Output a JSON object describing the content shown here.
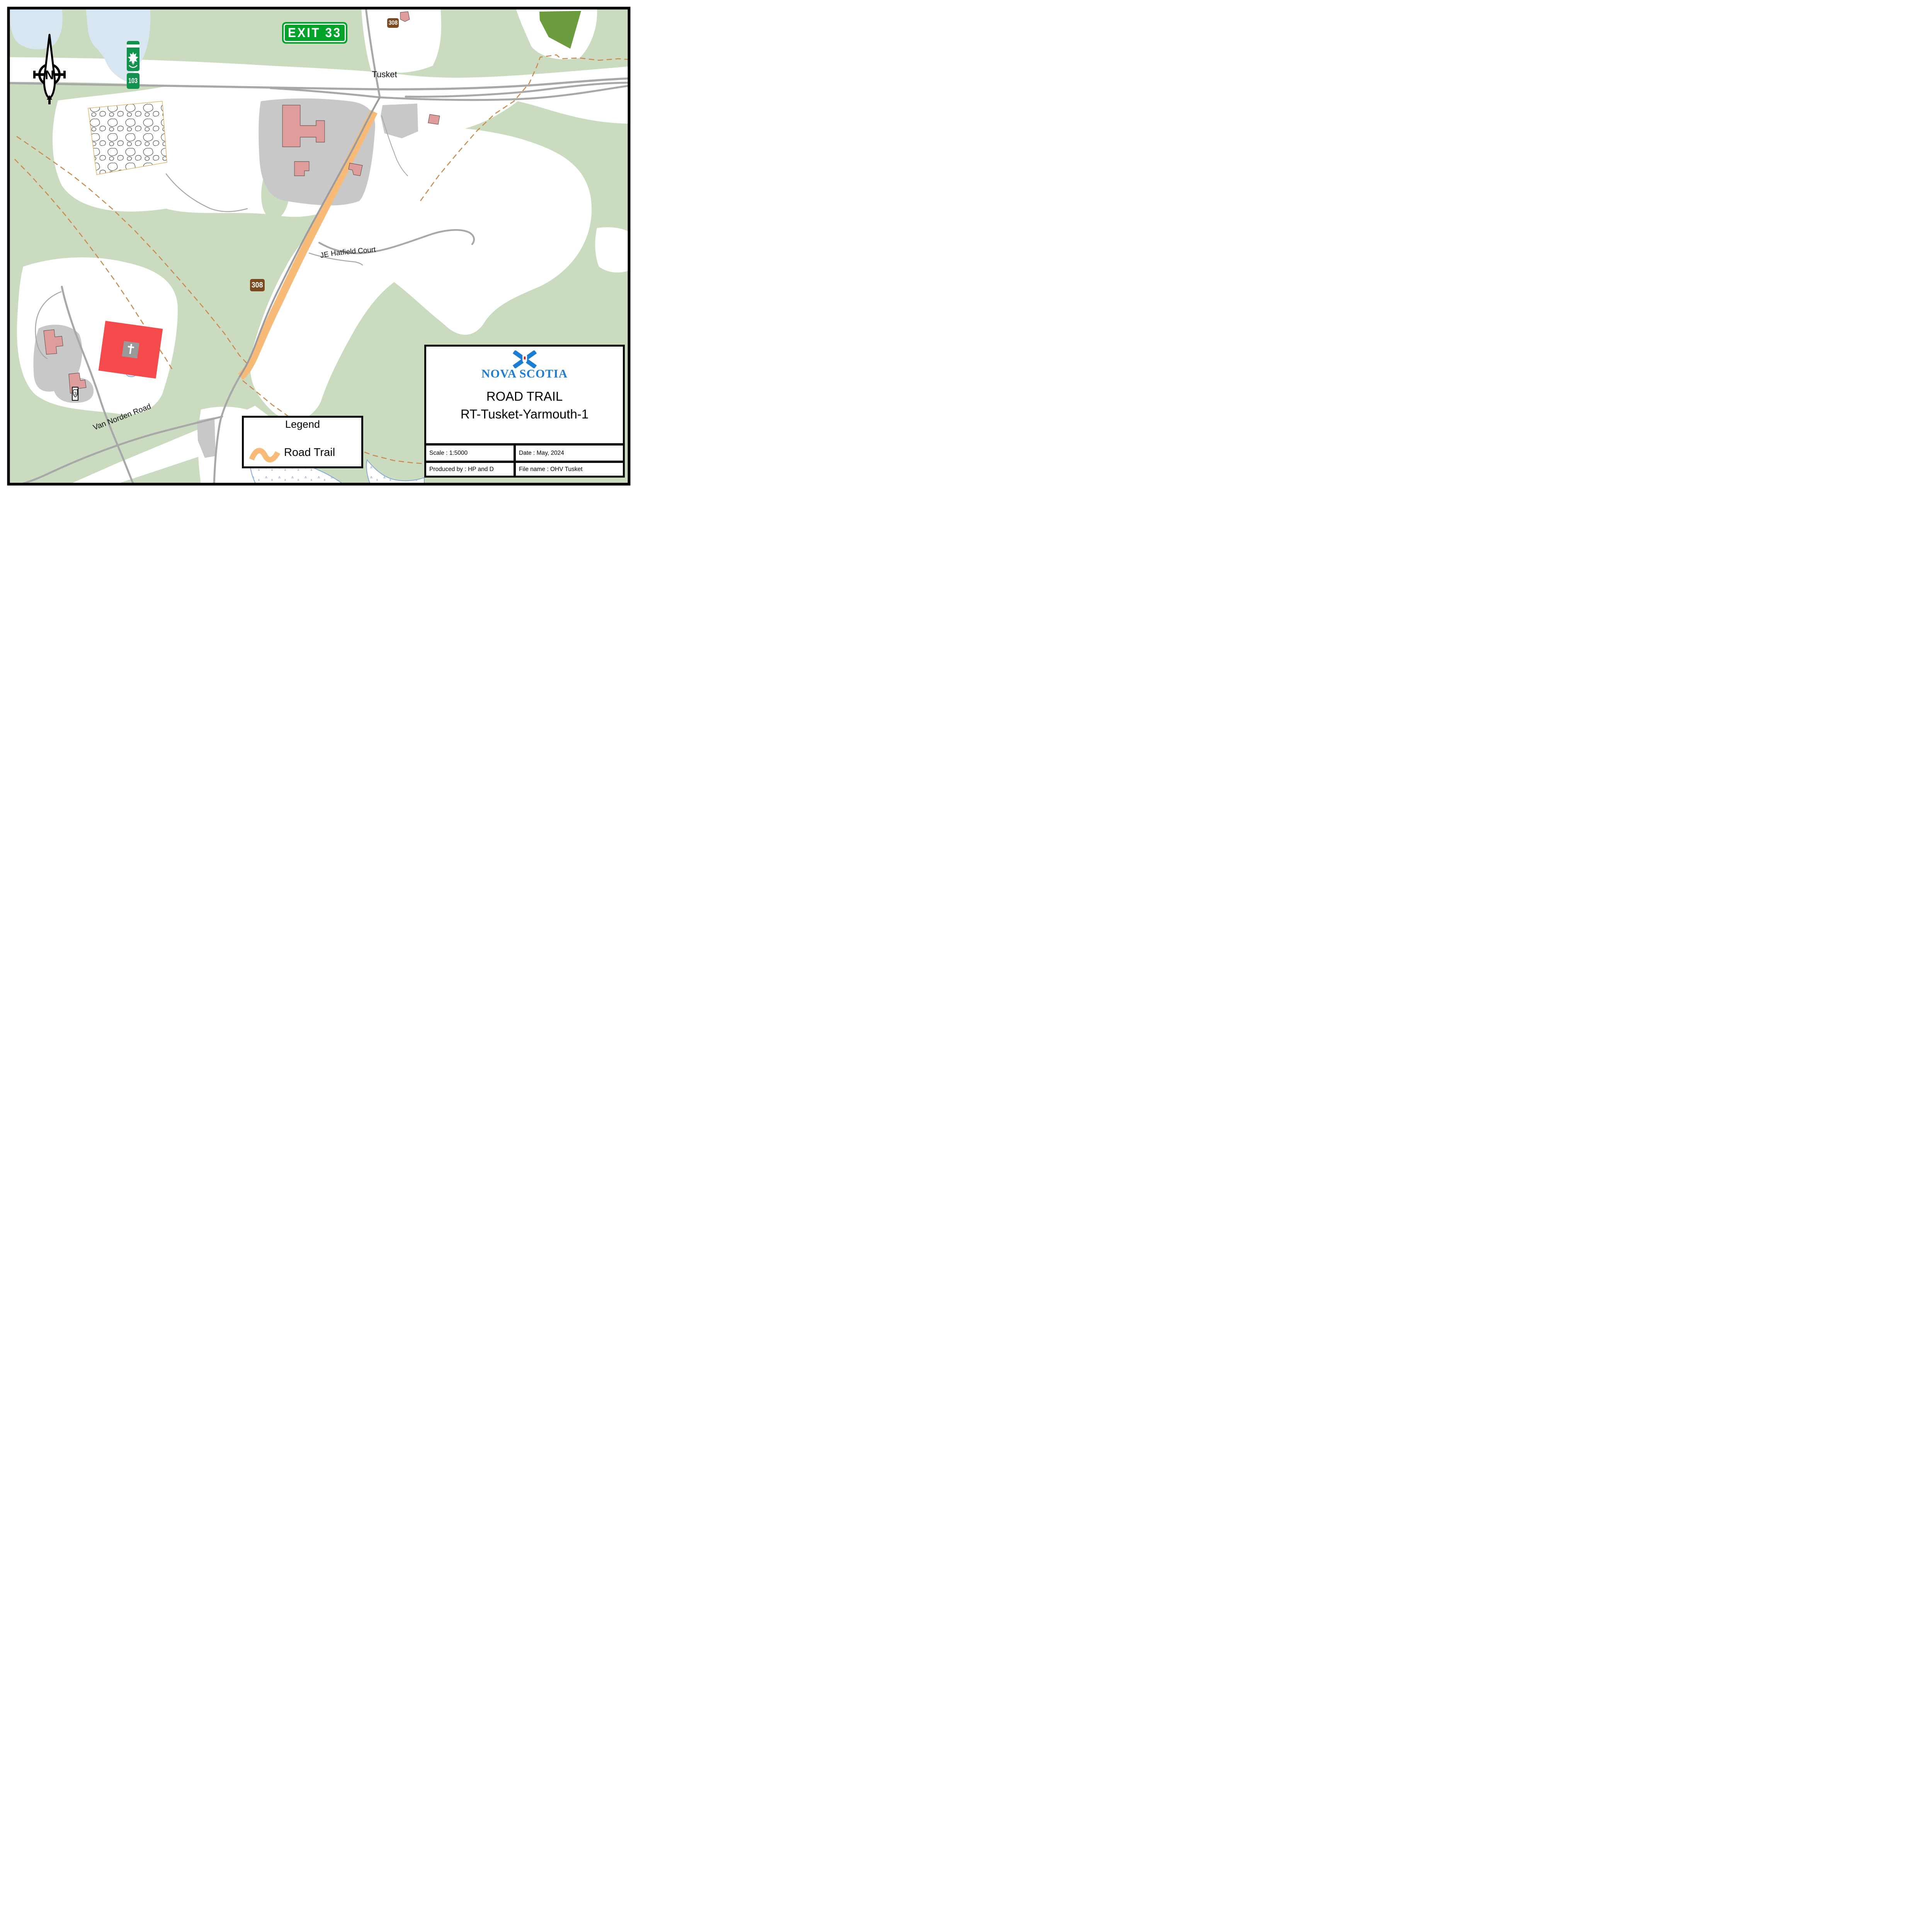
{
  "compass": {
    "label": "N"
  },
  "signs": {
    "exit": {
      "label": "EXIT 33",
      "bg": "#00A42B"
    },
    "hwy103": {
      "number": "103",
      "bg": "#11934F"
    },
    "route308_top": {
      "number": "308",
      "bg": "#7B4A21"
    },
    "route308_mid": {
      "number": "308",
      "bg": "#7B4A21"
    },
    "route3": {
      "number": "3"
    }
  },
  "labels": {
    "town": "Tusket",
    "road1": "JE Hatfield Court",
    "road2": "Van Norden Road"
  },
  "legend": {
    "title": "Legend",
    "item1": {
      "label": "Road Trail",
      "color": "#F7BB77"
    }
  },
  "title_block": {
    "brand": "NOVA SCOTIA",
    "line1": "ROAD TRAIL",
    "line2": "RT-Tusket-Yarmouth-1",
    "scale": "Scale : 1:5000",
    "date": "Date : May, 2024",
    "produced": "Produced by : HP and D",
    "file": "File name : OHV Tusket"
  },
  "colors": {
    "vegetation": "#CBDBC0",
    "water": "#D8E6F2",
    "forest_dark": "#6D9C3F",
    "road": "#A8A8A8",
    "trail_orange": "#F7BB77",
    "trail_dashed": "#C98A4F",
    "building_pink": "#DE9C9A",
    "church_red": "#F54A4C",
    "lot_gray": "#C8C8C8",
    "logo_blue": "#1B7ED3"
  }
}
